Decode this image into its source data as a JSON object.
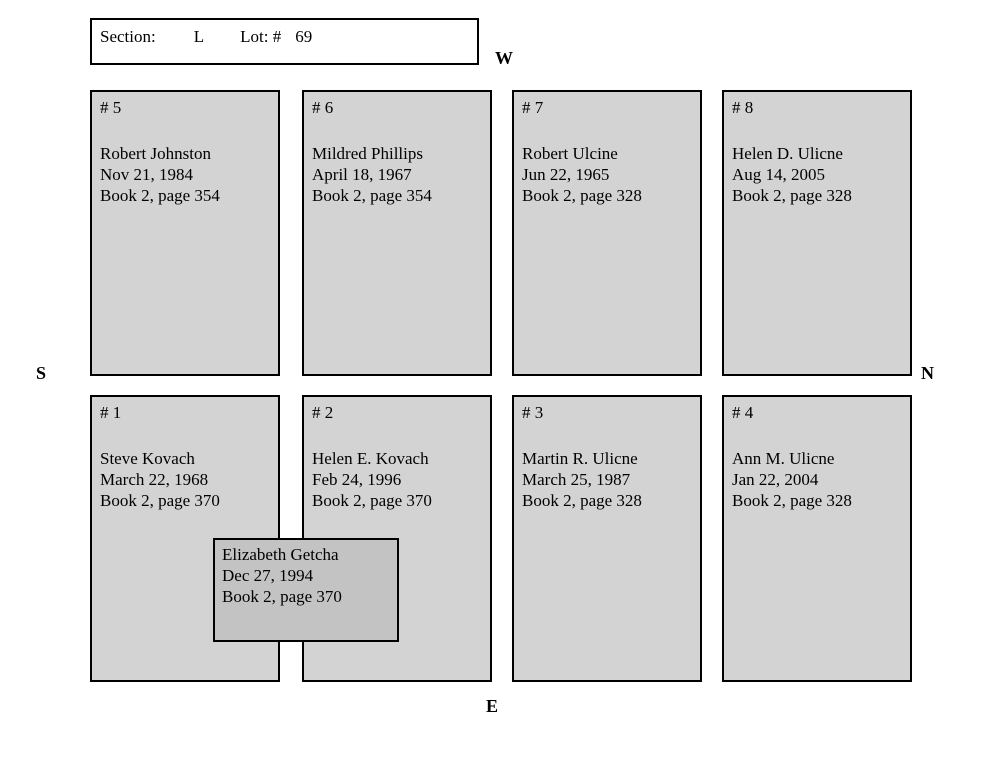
{
  "header": {
    "section_label": "Section:",
    "section_value": "L",
    "lot_label": "Lot: #",
    "lot_value": "69"
  },
  "compass": {
    "west": "W",
    "south": "S",
    "north": "N",
    "east": "E"
  },
  "plots": [
    {
      "number": "# 5",
      "name": "Robert Johnston",
      "date": "Nov 21, 1984",
      "book": "Book 2, page 354"
    },
    {
      "number": "# 6",
      "name": "Mildred Phillips",
      "date": "April 18, 1967",
      "book": "Book 2, page 354"
    },
    {
      "number": "# 7",
      "name": "Robert Ulcine",
      "date": "Jun 22, 1965",
      "book": "Book 2, page 328"
    },
    {
      "number": "# 8",
      "name": "Helen D. Ulicne",
      "date": "Aug 14, 2005",
      "book": "Book 2, page 328"
    },
    {
      "number": "# 1",
      "name": "Steve Kovach",
      "date": "March 22, 1968",
      "book": "Book 2, page 370"
    },
    {
      "number": "# 2",
      "name": "Helen E. Kovach",
      "date": "Feb 24, 1996",
      "book": "Book 2, page 370"
    },
    {
      "number": "# 3",
      "name": "Martin R. Ulicne",
      "date": "March 25, 1987",
      "book": "Book 2, page 328"
    },
    {
      "number": "# 4",
      "name": "Ann M. Ulicne",
      "date": "Jan 22, 2004",
      "book": "Book 2, page 328"
    }
  ],
  "overlay": {
    "name": "Elizabeth Getcha",
    "date": "Dec 27, 1994",
    "book": "Book 2, page 370"
  },
  "colors": {
    "plot_fill": "#d3d3d3",
    "overlay_fill": "#c3c3c3",
    "border": "#000000",
    "background": "#ffffff"
  }
}
